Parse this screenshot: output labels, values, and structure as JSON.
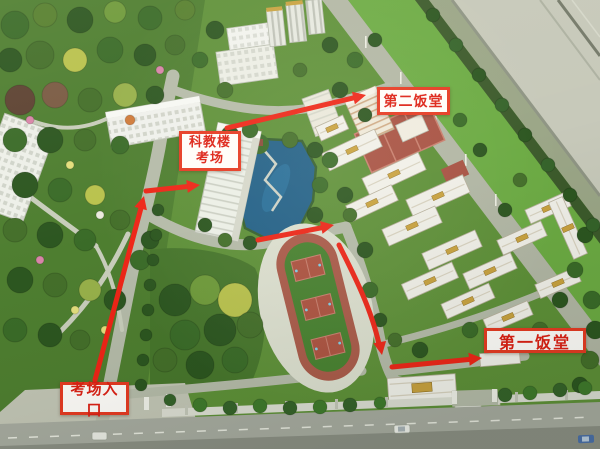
{
  "annotations": {
    "second_canteen": {
      "text": "第二饭堂"
    },
    "exam_building": {
      "line1": "科教楼",
      "line2": "考场"
    },
    "first_canteen": {
      "text": "第一饭堂"
    },
    "exam_entrance": {
      "text": "考场入口"
    }
  },
  "route_arrows": [
    {
      "id": "entrance-up-main-road"
    },
    {
      "id": "turn-right-to-exam-building"
    },
    {
      "id": "exam-building-to-second-canteen"
    },
    {
      "id": "east-below-lake"
    },
    {
      "id": "down-past-sports-field"
    },
    {
      "id": "east-to-first-canteen"
    }
  ],
  "colors": {
    "annotation_red": "#ee2517",
    "label_border_red": "#e63a22",
    "label_text_red": "#dd2014",
    "label_background": "#fffdfa",
    "grass_green": "#5e9038",
    "lake_blue": "#226087",
    "track_red": "#aa5a49"
  }
}
